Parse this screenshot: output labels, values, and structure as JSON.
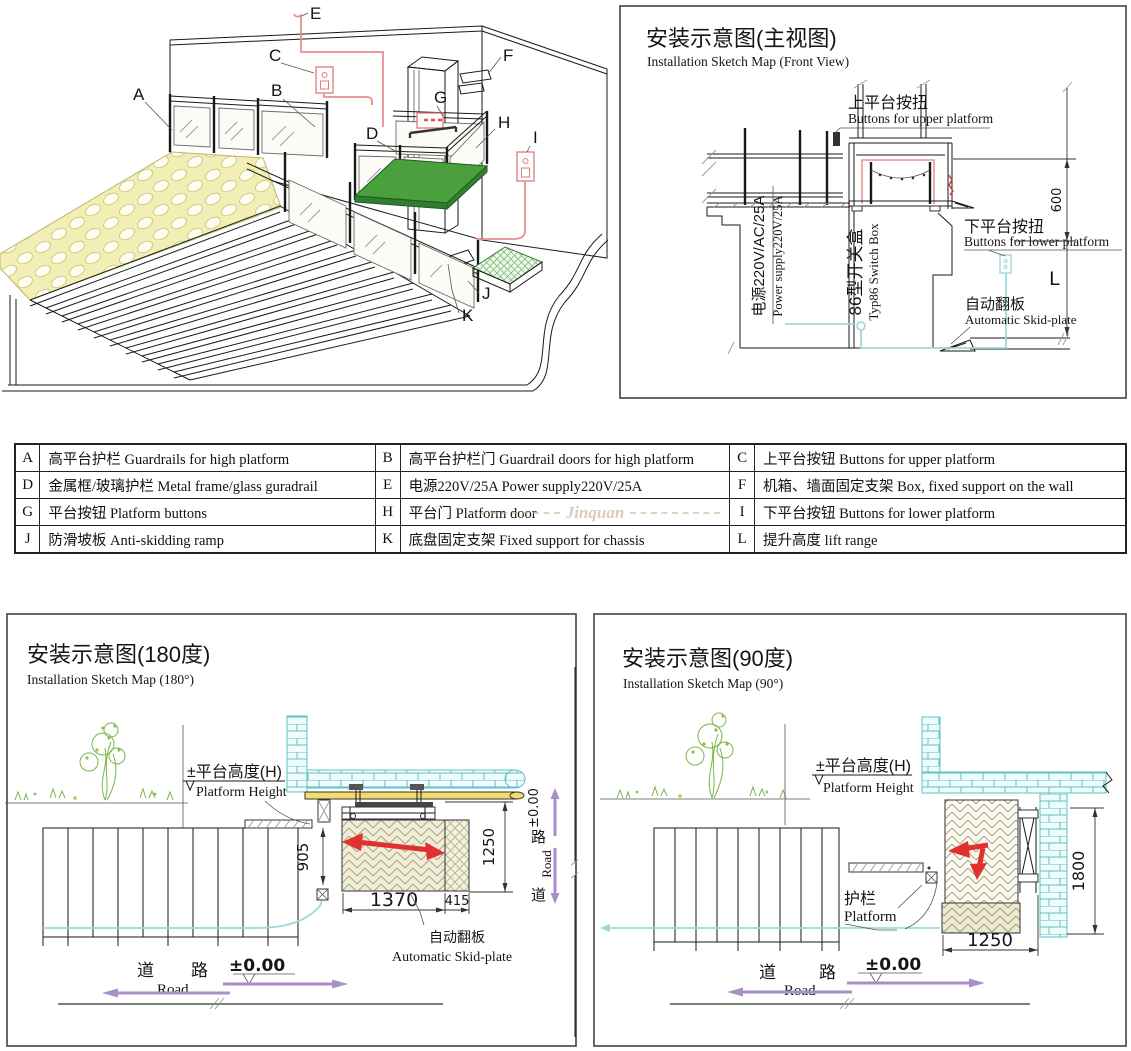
{
  "iso": {
    "labels": {
      "a": "A",
      "b": "B",
      "c": "C",
      "d": "D",
      "e": "E",
      "f": "F",
      "g": "G",
      "h": "H",
      "i": "I",
      "j": "J",
      "k": "K"
    }
  },
  "front": {
    "title_cn": "安装示意图(主视图)",
    "title_en": "Installation Sketch Map (Front View)",
    "upper_cn": "上平台按扭",
    "upper_en": "Buttons for upper platform",
    "lower_cn": "下平台按扭",
    "lower_en": "Buttons for lower platform",
    "power_cn": "电源220V/AC/25A",
    "power_en": "Power supply220V/25A",
    "switch_cn": "86型开关盒",
    "switch_en": "Typ86 Switch Box",
    "skid_cn": "自动翻板",
    "skid_en": "Automatic Skid-plate",
    "dim_600": "600",
    "dim_l": "L"
  },
  "parts_table": {
    "watermark": "Jinquan",
    "rows": [
      {
        "k1": "A",
        "d1": "高平台护栏 Guardrails for high platform",
        "k2": "B",
        "d2": "高平台护栏门 Guardrail doors for high platform",
        "k3": "C",
        "d3": "上平台按钮 Buttons for upper platform"
      },
      {
        "k1": "D",
        "d1": "金属框/玻璃护栏 Metal frame/glass guradrail",
        "k2": "E",
        "d2": "电源220V/25A Power supply220V/25A",
        "k3": "F",
        "d3": "机箱、墙面固定支架 Box, fixed support on the wall"
      },
      {
        "k1": "G",
        "d1": "平台按钮 Platform buttons",
        "k2": "H",
        "d2": "平台门 Platform door",
        "k3": "I",
        "d3": "下平台按钮 Buttons for lower platform"
      },
      {
        "k1": "J",
        "d1": "防滑坡板 Anti-skidding ramp",
        "k2": "K",
        "d2": "底盘固定支架 Fixed support for chassis",
        "k3": "L",
        "d3": "提升高度 lift range"
      }
    ]
  },
  "deg180": {
    "title_cn": "安装示意图(180度)",
    "title_en": "Installation Sketch Map (180°)",
    "height_cn": "±平台高度(H)",
    "height_en": "Platform Height",
    "skid_cn": "自动翻板",
    "skid_en": "Automatic Skid-plate",
    "dim_905": "905",
    "dim_1250": "1250",
    "dim_1370": "1370",
    "dim_415": "415",
    "road_cn_1": "道",
    "road_cn_2": "路",
    "road_en": "Road",
    "datum": "±0.00",
    "side_datum": "±0.00",
    "side_road_cn_1": "道",
    "side_road_cn_2": "路",
    "side_road_en": "Road"
  },
  "deg90": {
    "title_cn": "安装示意图(90度)",
    "title_en": "Installation Sketch Map (90°)",
    "height_cn": "±平台高度(H)",
    "height_en": "Platform Height",
    "rail_cn": "护栏",
    "rail_en": "Platform",
    "dim_1250": "1250",
    "dim_1800": "1800",
    "road_cn_1": "道",
    "road_cn_2": "路",
    "road_en": "Road",
    "datum": "±0.00"
  },
  "colors": {
    "wire_red": "#e39193",
    "arrow_red": "#e03030",
    "platform_green": "#4aa03c",
    "skid_green": "#7cbf7c",
    "brick_cyan": "#5fc0c4",
    "wire_cyan": "#9fd9d9",
    "road_purple": "#a98fc8",
    "cobble_yellow": "#f2eeb6",
    "deck_yellow": "#f2dc6e"
  }
}
